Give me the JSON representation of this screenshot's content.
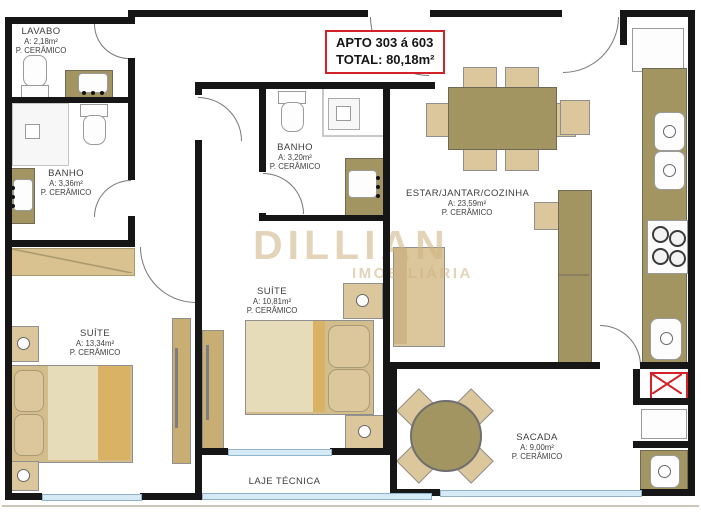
{
  "apto_box": {
    "line1": "APTO 303 á 603",
    "line2": "TOTAL: 80,18m²"
  },
  "watermark": {
    "name": "DILLIAN",
    "subtitle": "IMOBILIÁRIA"
  },
  "rooms": {
    "lavabo": {
      "name": "LAVABO",
      "area": "A: 2,18m²",
      "floor": "P. CERÂMICO"
    },
    "banho1": {
      "name": "BANHO",
      "area": "A: 3,36m²",
      "floor": "P. CERÂMICO"
    },
    "banho2": {
      "name": "BANHO",
      "area": "A: 3,20m²",
      "floor": "P. CERÂMICO"
    },
    "suite1": {
      "name": "SUÍTE",
      "area": "A: 13,34m²",
      "floor": "P. CERÂMICO"
    },
    "suite2": {
      "name": "SUÍTE",
      "area": "A: 10,81m²",
      "floor": "P. CERÂMICO"
    },
    "estar": {
      "name": "ESTAR/JANTAR/COZINHA",
      "area": "A: 23,59m²",
      "floor": "P. CERÂMICO"
    },
    "sacada": {
      "name": "SACADA",
      "area": "A: 9,00m²",
      "floor": "P. CERÂMICO"
    },
    "laje": {
      "name": "LAJE TÉCNICA"
    }
  },
  "colors": {
    "wall": "#161616",
    "accent_red": "#d3222a",
    "window_blue": "#d6eaf5",
    "furniture_tan_light": "#dcc69b",
    "furniture_tan_dark": "#a39562",
    "watermark_tan": "#cfb484"
  }
}
